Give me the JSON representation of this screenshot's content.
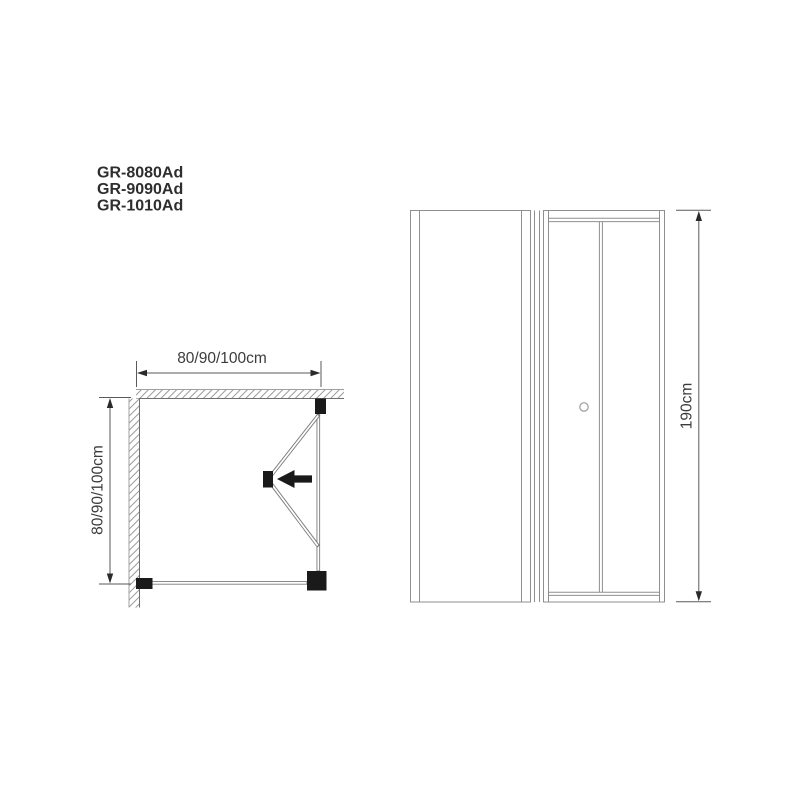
{
  "page": {
    "background": "#ffffff",
    "description": "Technical dimension drawing of a corner shower enclosure with bi-fold door: plan view and front elevation"
  },
  "models": {
    "items": [
      {
        "label": "GR-8080Ad"
      },
      {
        "label": "GR-9090Ad"
      },
      {
        "label": "GR-1010Ad"
      }
    ]
  },
  "plan_view": {
    "width_label": "80/90/100cm",
    "depth_label": "80/90/100cm",
    "door_swing_arrow_direction": "left",
    "walls": "hatched top and left walls"
  },
  "elevation_view": {
    "height_label": "190cm",
    "panels": [
      "fixed side panel",
      "bi-fold door with two leaves and knob"
    ]
  },
  "colors": {
    "background": "#ffffff",
    "frame_line": "#8f8f8f",
    "dimension_line": "#5a5a5a",
    "hatch_line": "#9a9a9a",
    "block_fill": "#1a1a1a",
    "text": "#2e2e2e"
  }
}
